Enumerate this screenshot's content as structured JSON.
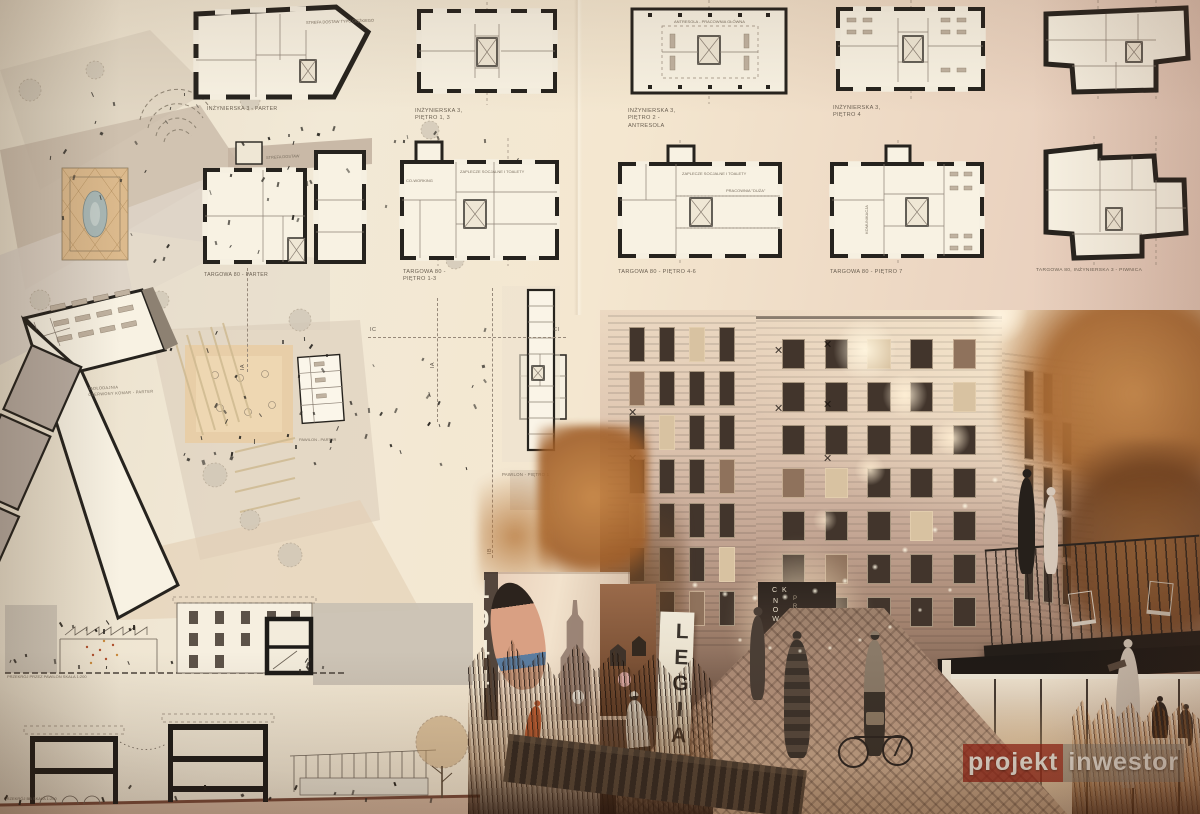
{
  "row1": {
    "p1_label": "INŻYNIERSKA 3 - PARTER",
    "p2_lines": [
      "INŻYNIERSKA 3,",
      "PIĘTRO 1, 3"
    ],
    "p3_lines": [
      "INŻYNIERSKA 3,",
      "PIĘTRO 2 -",
      "ANTRESOLA"
    ],
    "p3_room": "ANTRESOLA - PRACOWNIA GŁÓWNA",
    "p4_lines": [
      "INŻYNIERSKA 3,",
      "PIĘTRO 4"
    ]
  },
  "row2": {
    "q1_label": "TARGOWA 80 - PARTER",
    "q2_lines": [
      "TARGOWA 80 -",
      "PIĘTRO 1-3"
    ],
    "q2_room1": "ZAPLECZE SOCJALNE I TOALETY",
    "q2_room2": "CO-WORKING",
    "q3_label": "TARGOWA 80 - PIĘTRO 4-6",
    "q3_room1": "ZAPLECZE SOCJALNE I TOALETY",
    "q3_room2": "PRACOWNIA \"DUŻA\"",
    "q4_label": "TARGOWA 80 - PIĘTRO 7",
    "q4_room1": "KOMUNIKACJA",
    "piwnica_label": "TARGOWA 80, INŻYNIERSKA 3 - PIWNICA"
  },
  "siteplan": {
    "strefa_ciezka": "STREFA DOSTAW TYPU CIĘŻKIEGO",
    "strefa_dostaw": "STREFA DOSTAW",
    "jadlodajnia_lines": [
      "JADŁODAJNIA",
      "CZERWONY KOMAR - PARTER"
    ],
    "pawilon_parter": "PAWILON - PARTER",
    "pawilon_pietro1": "PAWILON - PIĘTRO 1",
    "markers": {
      "ic": "IC",
      "ci": "CI",
      "ia": "IA",
      "ib": "IB"
    }
  },
  "sections": {
    "s1_label": "PRZEKRÓJ PRZEZ PAWILON SKALA 1:200",
    "s2_label": "PRZEKRÓJ BB SKALA 1:200"
  },
  "render": {
    "legia": "LEGIA",
    "door_line1": "CK",
    "door_line2": "NOWA",
    "door_line3": "PRAGA",
    "mural_digits": [
      "1",
      "9",
      "4",
      "4"
    ]
  },
  "watermark": {
    "part1": "projekt",
    "part2": "inwestor"
  }
}
